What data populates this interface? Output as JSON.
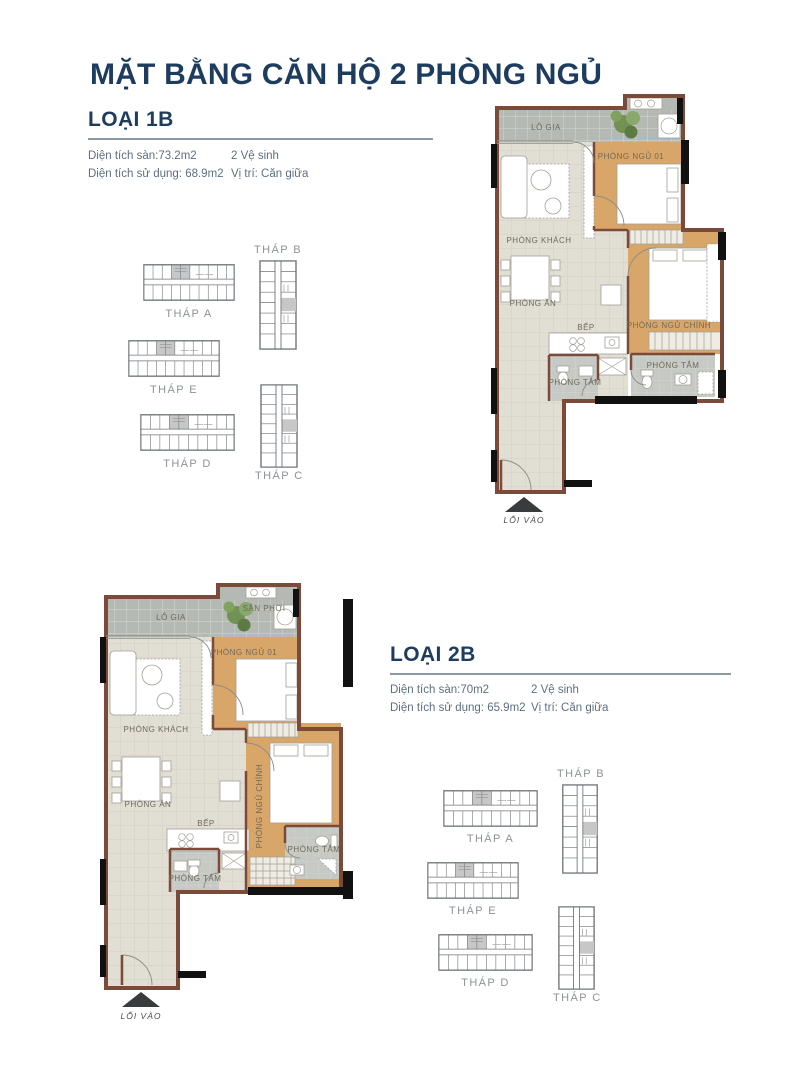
{
  "page": {
    "title": "MẶT BẰNG CĂN HỘ 2 PHÒNG NGỦ"
  },
  "colors": {
    "accent_navy": "#1d3c5e",
    "body_text": "#5d6f80",
    "wall_brown": "#7c4a38",
    "wood_floor": "#d9a66a",
    "tile_gray": "#b5b9b3",
    "floor_beige": "#e1ded4",
    "bath_gray": "#c6c9c4"
  },
  "loai_1b": {
    "heading": "LOẠI 1B",
    "area_floor": "Diện tích sàn:73.2m2",
    "toilets": "2 Vệ sinh",
    "area_usable": "Diện tích sử dụng: 68.9m2",
    "position": "Vị trí: Căn giữa"
  },
  "loai_2b": {
    "heading": "LOẠI 2B",
    "area_floor": "Diện tích sàn:70m2",
    "toilets": "2 Vệ sinh",
    "area_usable": "Diện tích sử dụng: 65.9m2",
    "position": "Vị trí: Căn giữa"
  },
  "plan_1b": {
    "rooms": {
      "balcony": "LÔ GIA",
      "bedroom1": "PHÒNG NGỦ 01",
      "living": "PHÒNG KHÁCH",
      "dining": "PHÒNG ĂN",
      "kitchen": "BẾP",
      "master": "PHÒNG NGỦ CHÍNH",
      "bath1": "PHÒNG TẮM",
      "bath2": "PHÒNG TẮM",
      "entrance": "LỐI VÀO"
    }
  },
  "plan_2b": {
    "rooms": {
      "balcony": "LÔ GIA",
      "drying": "SÂN PHƠI",
      "bedroom1": "PHÒNG NGỦ 01",
      "living": "PHÒNG KHÁCH",
      "dining": "PHÒNG ĂN",
      "kitchen": "BẾP",
      "master": "PHÒNG NGỦ CHÍNH",
      "bath1": "PHÒNG TẮM",
      "bath2": "PHÒNG TẮM",
      "entrance": "LỐI VÀO"
    }
  },
  "tower_map": {
    "thap_a": "THÁP A",
    "thap_b": "THÁP B",
    "thap_c": "THÁP C",
    "thap_d": "THÁP D",
    "thap_e": "THÁP E"
  }
}
